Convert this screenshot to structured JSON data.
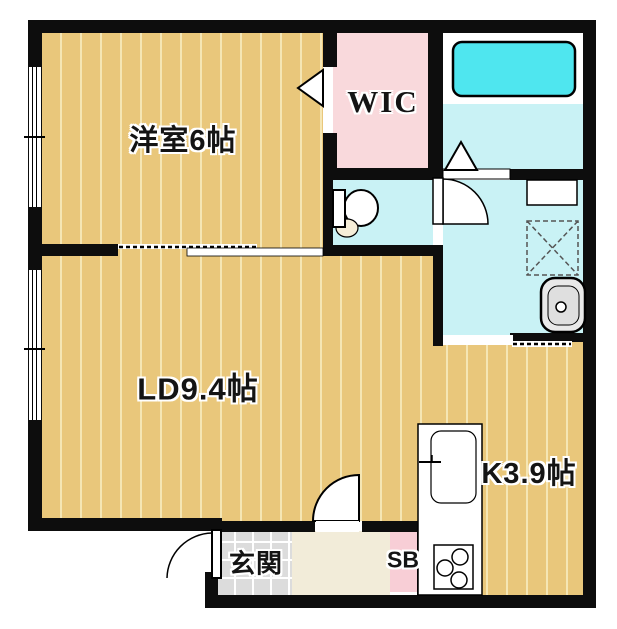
{
  "plan": {
    "type": "apartment-floorplan-1LDK",
    "labels": {
      "western_room": "洋室6帖",
      "wic": "WIC",
      "living_dining": "LD9.4帖",
      "kitchen": "K3.9帖",
      "entrance": "玄関",
      "shoe_box": "SB"
    },
    "colors": {
      "floor_tan": "#e9c77b",
      "floor_stripe": "#f5e6b4",
      "wall_black": "#0d0d0d",
      "wic_pink": "#f9d9dc",
      "sb_pink": "#f8ced6",
      "wet_cyan": "#c9f2f5",
      "tub_cyan": "#4fe6ef",
      "tile_gray": "#dcdcdc",
      "tile_line": "#ffffff",
      "hall_cream": "#f2ecd9",
      "basin_gray": "#e9e9e9"
    },
    "fixtures": [
      "bathtub",
      "toilet",
      "washbasin",
      "washer-pan",
      "washroom-counter",
      "kitchen-counter",
      "kitchen-sink",
      "gas-stove"
    ],
    "openings": [
      "wic-door",
      "bedroom-sliding-door",
      "toilet-door",
      "bath-folding-door",
      "washroom-sliding-door",
      "living-door",
      "entrance-door",
      "window-bedroom",
      "window-living"
    ]
  }
}
